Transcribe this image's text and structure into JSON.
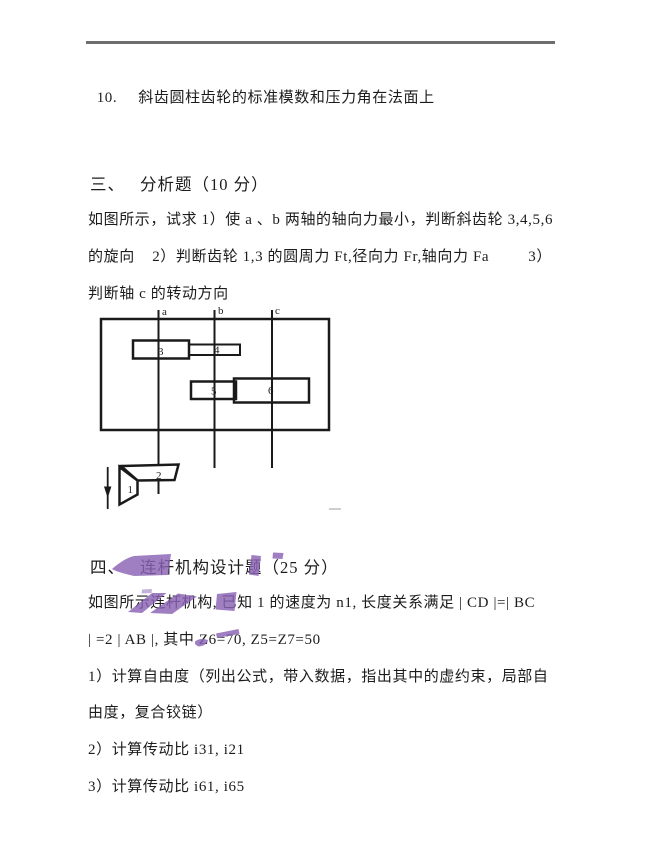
{
  "page": {
    "background": "#ffffff",
    "text_color": "#1c1c1c",
    "rule_color": "#6e6e6e",
    "annotation_color": "#8a63b3",
    "faint_mark_color": "#bdbdbd"
  },
  "item10": {
    "number": "10.",
    "text": "斜齿圆柱齿轮的标准模数和压力角在法面上"
  },
  "section3": {
    "heading_number": "三、",
    "heading_title": "分析题（10 分）",
    "lines": [
      "如图所示，试求 1）使 a 、b 两轴的轴向力最小，判断斜齿轮 3,4,5,6",
      "的旋向    2）判断齿轮 1,3 的圆周力 Ft,径向力 Fr,轴向力 Fa         3）",
      "判断轴 c 的转动方向"
    ]
  },
  "diagram": {
    "shaft_labels": {
      "a": "a",
      "b": "b",
      "c": "c"
    },
    "gear_labels": {
      "g1": "1",
      "g2": "2",
      "g3": "3",
      "g4": "4",
      "g5": "5",
      "g6": "6"
    }
  },
  "section4": {
    "heading_number": "四、",
    "heading_title": "连杆机构设计题（25 分）",
    "lines": [
      "如图所示连杆机构, 已知 1 的速度为 n1, 长度关系满足 | CD |=| BC",
      "| =2 | AB |, 其中 Z6=70, Z5=Z7=50"
    ],
    "items": [
      "1）计算自由度（列出公式，带入数据，指出其中的虚约束，局部自",
      "由度，复合铰链）",
      "2）计算传动比 i31, i21",
      "3）计算传动比 i61, i65"
    ]
  }
}
